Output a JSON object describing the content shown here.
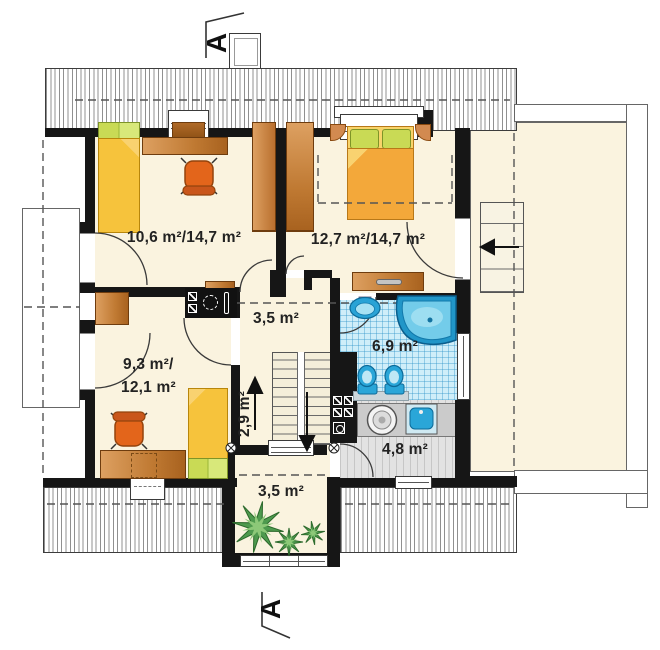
{
  "section_markers": {
    "top_label": "A",
    "bottom_label": "A"
  },
  "rooms": {
    "bedroom_left": {
      "area_label": "10,6 m²/14,7 m²"
    },
    "bedroom_right": {
      "area_label": "12,7 m²/14,7 m²"
    },
    "hall": {
      "area_label": "3,5 m²"
    },
    "bathroom": {
      "area_label": "6,9 m²"
    },
    "staircase": {
      "area_label": "2,9 m²"
    },
    "bedroom_lower": {
      "area_label_line1": "9,3 m²/",
      "area_label_line2": "12,1 m²"
    },
    "utility": {
      "area_label": "4,8 m²"
    },
    "balcony": {
      "area_label": "3,5 m²"
    }
  },
  "palette": {
    "wall": "#161616",
    "floor_cream": "#faf3df",
    "bath_tile": "#cfeef9",
    "fixture_blue": "#2aa6d8",
    "tub_blue": "#2196c8",
    "wood_brown": "#c07a33",
    "bed_yellow": "#f6c33c",
    "pillow_green": "#c9da55",
    "chair_orange": "#e3651b",
    "plant_green": "#4e9a4e",
    "laundry_gray": "#e2e2e2",
    "hatch_line": "#909090"
  },
  "icons": {
    "bathtub-icon": "corner-tub shape",
    "washbasin-icon": "oval basin",
    "toilet-icon": "bowl with tank",
    "washing-machine-icon": "drum circle",
    "laundry-sink-icon": "square basin",
    "plant-icon": "starburst leaves",
    "bed-icon": "mattress with pillow",
    "desk-chair-icon": "swivel chair",
    "stairs-up-arrow-icon": "arrow up",
    "stairs-down-arrow-icon": "arrow down",
    "attic-stairs-arrow-icon": "arrow left",
    "duct-icon": "squares with diagonals",
    "kitchenette-icon": "hob and sink glyphs",
    "wall-junction-icon": "circled x",
    "section-marker-icon": "section cut line"
  }
}
